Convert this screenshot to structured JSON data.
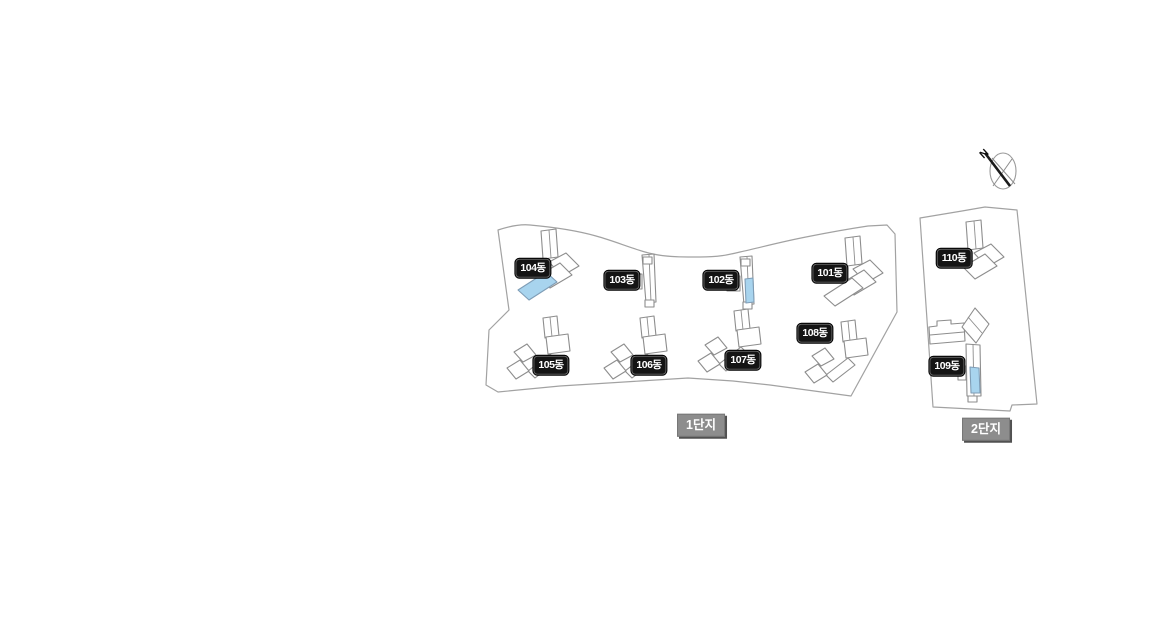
{
  "areas": [
    {
      "id": "complex-1",
      "label": "1단지"
    },
    {
      "id": "complex-2",
      "label": "2단지"
    }
  ],
  "buildings": [
    {
      "id": "101",
      "label": "101동",
      "highlighted": false
    },
    {
      "id": "102",
      "label": "102동",
      "highlighted": true
    },
    {
      "id": "103",
      "label": "103동",
      "highlighted": false
    },
    {
      "id": "104",
      "label": "104동",
      "highlighted": true
    },
    {
      "id": "105",
      "label": "105동",
      "highlighted": false
    },
    {
      "id": "106",
      "label": "106동",
      "highlighted": false
    },
    {
      "id": "107",
      "label": "107동",
      "highlighted": false
    },
    {
      "id": "108",
      "label": "108동",
      "highlighted": false
    },
    {
      "id": "109",
      "label": "109동",
      "highlighted": true
    },
    {
      "id": "110",
      "label": "110동",
      "highlighted": false
    }
  ],
  "compass": {
    "label": "N"
  },
  "colors": {
    "building_outline": "#8d8d8d",
    "boundary_outline": "#a2a2a2",
    "highlight_fill": "#a8d4ee",
    "highlight_outline": "#7f9db6",
    "building_label_bg": "#141414",
    "building_label_text": "#ffffff",
    "area_label_bg": "#8d8d8d",
    "area_label_text": "#ffffff",
    "area_label_shadow": "#515151"
  }
}
